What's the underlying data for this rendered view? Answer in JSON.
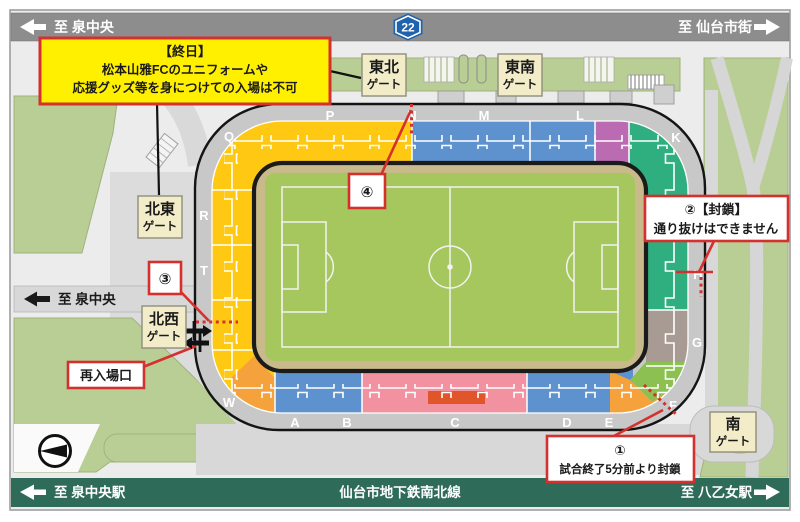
{
  "colors": {
    "frame_gray": "#9e9e9e",
    "map_bg": "#ececec",
    "road_bar_gray": "#8d8d8d",
    "metro_green": "#2e6b59",
    "route_badge_blue": "#1f63ae",
    "landscape_green": "#b9ce95",
    "road_gray": "#d8d8d8",
    "walkway_gray": "#c8c8c8",
    "notice_yellow": "#fff000",
    "notice_red": "#d4302e",
    "gate_tan": "#f2ecc9",
    "stand_yellow": "#ffc813",
    "stand_blue": "#5e92ce",
    "stand_purple": "#ba6bb1",
    "stand_teal": "#2faf7f",
    "stand_taupe": "#a89b94",
    "stand_orange": "#f5a23c",
    "stand_pink": "#f291a0",
    "stand_red_block": "#e0562a",
    "stand_light_green": "#8cc152",
    "field_green": "#a5c75e",
    "track_tan": "#c9ba8c"
  },
  "icons": {
    "top_left_arrow": "left-arrow",
    "top_right_arrow": "right-arrow",
    "mid_left_arrow": "left-arrow",
    "metro_left_arrow": "left-arrow",
    "metro_right_arrow": "right-arrow",
    "compass": "compass-left-pointer",
    "gate_arrows": "in-out-arrows"
  },
  "roads": {
    "top": {
      "left": "至 泉中央",
      "route": "22",
      "right": "至 仙台市街"
    },
    "mid_left": "至 泉中央",
    "metro": {
      "left": "至 泉中央駅",
      "center": "仙台市地下鉄南北線",
      "right": "至 八乙女駅"
    }
  },
  "gates": {
    "east_north": {
      "line1": "東北",
      "line2": "ゲート"
    },
    "east_south": {
      "line1": "東南",
      "line2": "ゲート"
    },
    "north_east": {
      "line1": "北東",
      "line2": "ゲート"
    },
    "north_west": {
      "line1": "北西",
      "line2": "ゲート"
    },
    "south": {
      "line1": "南",
      "line2": "ゲート"
    }
  },
  "notices": {
    "allday": {
      "line1": "【終日】",
      "line2": "松本山雅FCのユニフォームや",
      "line3": "応援グッズ等を身につけての入場は不可"
    },
    "reentry": "再入場口",
    "closure1": {
      "num": "①",
      "text": "試合終了5分前より封鎖"
    },
    "closure2": {
      "line1": "②【封鎖】",
      "line2": "通り抜けはできません"
    },
    "point3": "③",
    "point4": "④"
  },
  "stadium": {
    "letters": {
      "q": "Q",
      "p": "P",
      "n": "N",
      "m": "M",
      "l": "L",
      "k": "K",
      "r": "R",
      "t": "T",
      "w": "W",
      "a": "A",
      "b": "B",
      "c": "C",
      "d": "D",
      "e": "E",
      "f": "F",
      "g": "G",
      "h": "H"
    }
  }
}
